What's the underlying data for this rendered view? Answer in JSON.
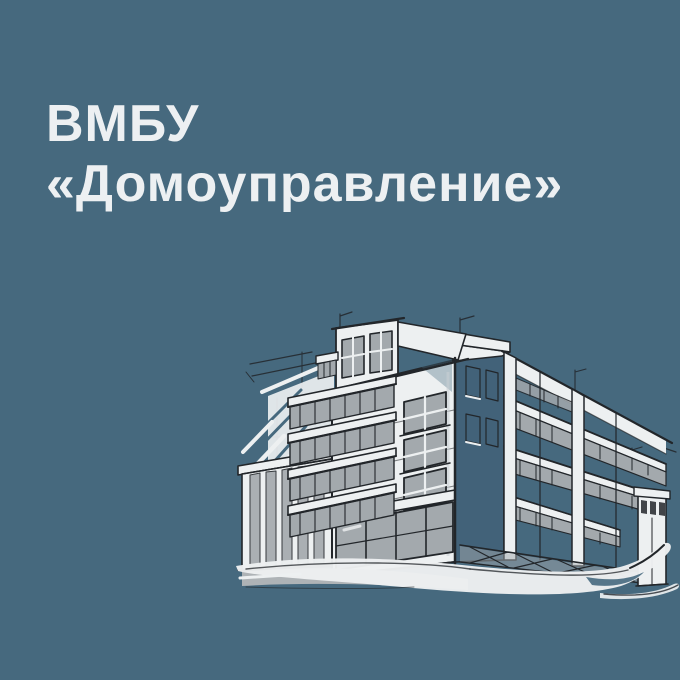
{
  "header": {
    "title_line1": "ВМБУ",
    "title_line2": "«Домоуправление»",
    "title_full": "ВМБУ «Домоуправление»"
  },
  "illustration": {
    "alt": "Hand-drawn ink sketch of a multi-storey corner apartment building with balconies and a curving street"
  },
  "colors": {
    "background": "#46697e",
    "heading": "#edf0f2",
    "paper": "#edf0f1",
    "ink": "#22262a",
    "glass": "#a3a9ad",
    "shadow": "#426279",
    "road": "#b4b7b9"
  }
}
